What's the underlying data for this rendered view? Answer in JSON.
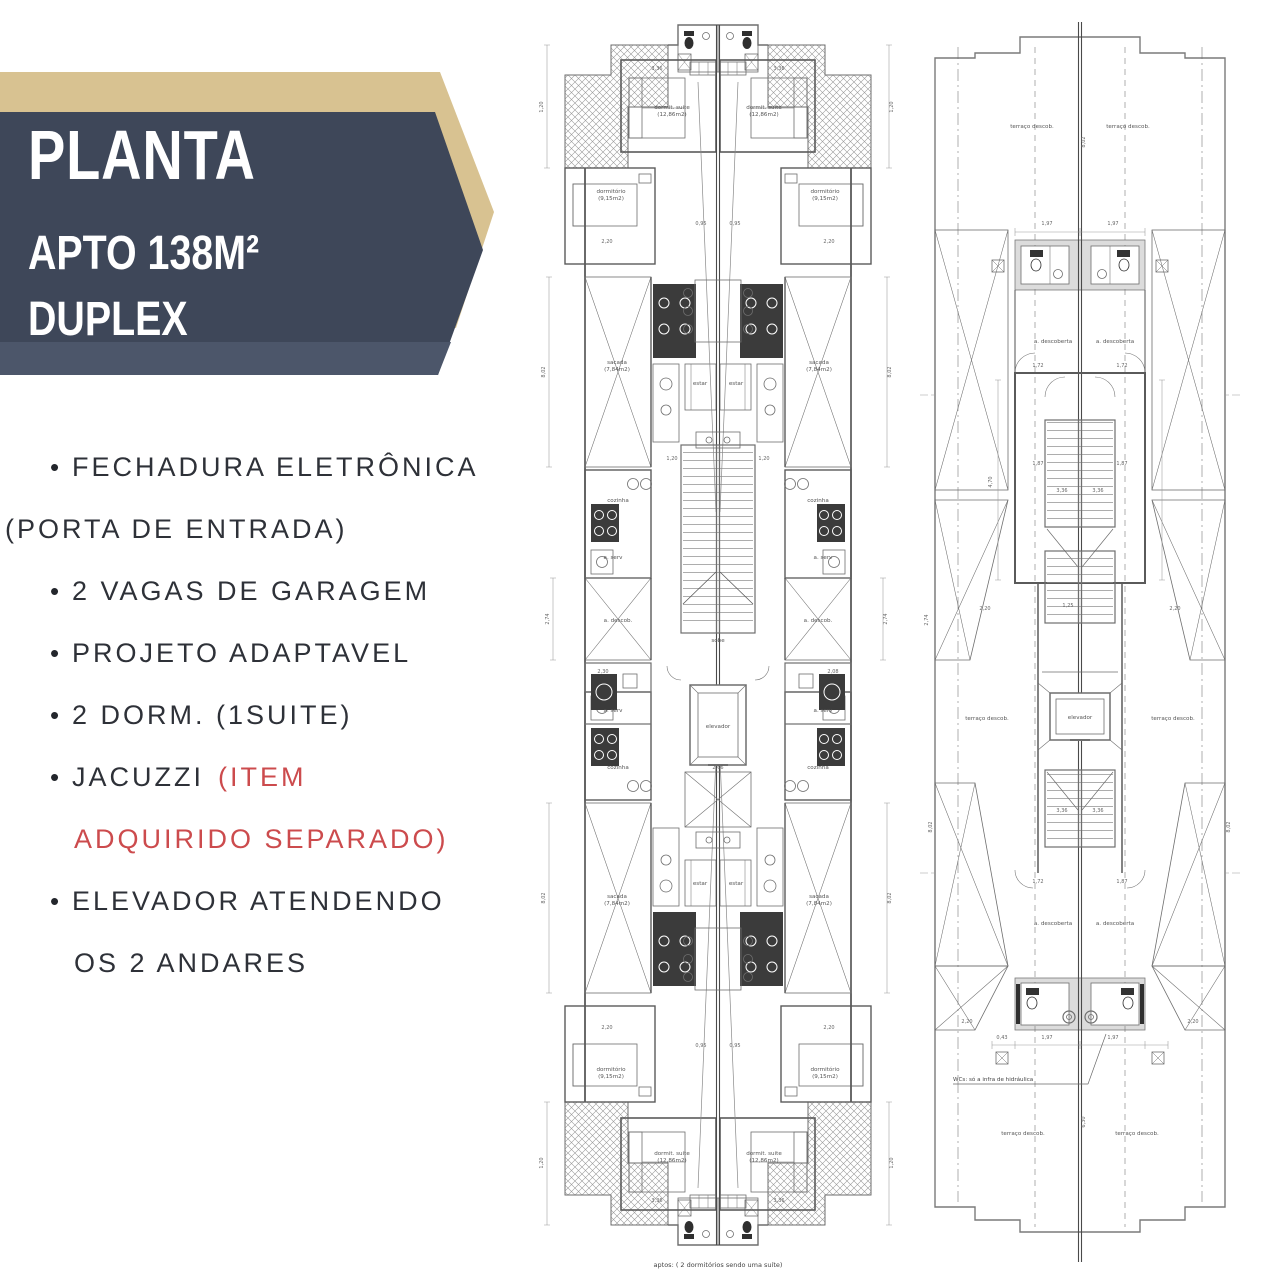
{
  "banner": {
    "title": "PLANTA",
    "subtitle": "APTO 138M²",
    "subtitle2": "DUPLEX",
    "accent_color": "#d8c291",
    "navy_color": "#3e4759"
  },
  "features": {
    "f1a": "FECHADURA ELETRÔNICA",
    "f1b": "(PORTA DE ENTRADA)",
    "f2": "2 VAGAS DE GARAGEM",
    "f3": "PROJETO ADAPTAVEL",
    "f4": "2 DORM. (1SUITE)",
    "f5a": "JACUZZI",
    "f5b": "(ITEM",
    "f5c": "ADQUIRIDO SEPARADO)",
    "f6a": "ELEVADOR ATENDENDO",
    "f6b": "OS 2 ANDARES",
    "highlight_color": "#cc4b4d"
  },
  "center_plan": {
    "caption": "aptos: ( 2 dormitórios sendo uma suíte)",
    "labels": [
      {
        "t": "dormit. suite",
        "x": 139,
        "y": 97
      },
      {
        "t": "(12,86m2)",
        "x": 139,
        "y": 104
      },
      {
        "t": "dormit. suite",
        "x": 231,
        "y": 97
      },
      {
        "t": "(12,86m2)",
        "x": 231,
        "y": 104
      },
      {
        "t": "dormitório",
        "x": 78,
        "y": 181
      },
      {
        "t": "(9,15m2)",
        "x": 78,
        "y": 188
      },
      {
        "t": "dormitório",
        "x": 292,
        "y": 181
      },
      {
        "t": "(9,15m2)",
        "x": 292,
        "y": 188
      },
      {
        "t": "sacada",
        "x": 84,
        "y": 352
      },
      {
        "t": "(7,84m2)",
        "x": 84,
        "y": 359
      },
      {
        "t": "sacada",
        "x": 286,
        "y": 352
      },
      {
        "t": "(7,84m2)",
        "x": 286,
        "y": 359
      },
      {
        "t": "estar",
        "x": 167,
        "y": 373
      },
      {
        "t": "estar",
        "x": 203,
        "y": 373
      },
      {
        "t": "cozinha",
        "x": 85,
        "y": 490
      },
      {
        "t": "cozinha",
        "x": 285,
        "y": 490
      },
      {
        "t": "a. serv",
        "x": 80,
        "y": 547
      },
      {
        "t": "a. serv",
        "x": 290,
        "y": 547
      },
      {
        "t": "a. descob.",
        "x": 85,
        "y": 610
      },
      {
        "t": "a. descob.",
        "x": 285,
        "y": 610
      },
      {
        "t": "sobe",
        "x": 185,
        "y": 630
      },
      {
        "t": "elevador",
        "x": 185,
        "y": 716
      },
      {
        "t": "a. serv",
        "x": 80,
        "y": 700
      },
      {
        "t": "a. serv",
        "x": 290,
        "y": 700
      },
      {
        "t": "cozinha",
        "x": 85,
        "y": 757
      },
      {
        "t": "cozinha",
        "x": 285,
        "y": 757
      },
      {
        "t": "estar",
        "x": 167,
        "y": 873
      },
      {
        "t": "estar",
        "x": 203,
        "y": 873
      },
      {
        "t": "sacada",
        "x": 84,
        "y": 886
      },
      {
        "t": "(7,84m2)",
        "x": 84,
        "y": 893
      },
      {
        "t": "sacada",
        "x": 286,
        "y": 886
      },
      {
        "t": "(7,84m2)",
        "x": 286,
        "y": 893
      },
      {
        "t": "dormitório",
        "x": 78,
        "y": 1059
      },
      {
        "t": "(9,15m2)",
        "x": 78,
        "y": 1066
      },
      {
        "t": "dormitório",
        "x": 292,
        "y": 1059
      },
      {
        "t": "(9,15m2)",
        "x": 292,
        "y": 1066
      },
      {
        "t": "dormit. suite",
        "x": 139,
        "y": 1143
      },
      {
        "t": "(12,86m2)",
        "x": 139,
        "y": 1150
      },
      {
        "t": "dormit. suite",
        "x": 231,
        "y": 1143
      },
      {
        "t": "(12,86m2)",
        "x": 231,
        "y": 1150
      }
    ],
    "dims": [
      {
        "t": "1,20",
        "x": 10,
        "y": 95,
        "r": 1
      },
      {
        "t": "8,02",
        "x": 12,
        "y": 360,
        "r": 1
      },
      {
        "t": "2,74",
        "x": 16,
        "y": 607,
        "r": 1
      },
      {
        "t": "8,02",
        "x": 12,
        "y": 886,
        "r": 1
      },
      {
        "t": "1,20",
        "x": 10,
        "y": 1151,
        "r": 1
      },
      {
        "t": "1,20",
        "x": 360,
        "y": 95,
        "r": 1
      },
      {
        "t": "8,02",
        "x": 358,
        "y": 360,
        "r": 1
      },
      {
        "t": "2,74",
        "x": 354,
        "y": 607,
        "r": 1
      },
      {
        "t": "8,02",
        "x": 358,
        "y": 886,
        "r": 1
      },
      {
        "t": "1,20",
        "x": 360,
        "y": 1151,
        "r": 1
      },
      {
        "t": "3,36",
        "x": 124,
        "y": 58
      },
      {
        "t": "3,36",
        "x": 246,
        "y": 58
      },
      {
        "t": "2,20",
        "x": 74,
        "y": 231
      },
      {
        "t": "2,20",
        "x": 296,
        "y": 231
      },
      {
        "t": "0,95",
        "x": 168,
        "y": 213
      },
      {
        "t": "0,95",
        "x": 202,
        "y": 213
      },
      {
        "t": "1,20",
        "x": 139,
        "y": 448
      },
      {
        "t": "1,20",
        "x": 231,
        "y": 448
      },
      {
        "t": "2,30",
        "x": 70,
        "y": 661
      },
      {
        "t": "2,08",
        "x": 300,
        "y": 661
      },
      {
        "t": "2,66",
        "x": 185,
        "y": 757
      },
      {
        "t": "2,20",
        "x": 74,
        "y": 1017
      },
      {
        "t": "2,20",
        "x": 296,
        "y": 1017
      },
      {
        "t": "0,95",
        "x": 168,
        "y": 1035
      },
      {
        "t": "0,95",
        "x": 202,
        "y": 1035
      },
      {
        "t": "3,36",
        "x": 124,
        "y": 1190
      },
      {
        "t": "3,36",
        "x": 246,
        "y": 1190
      }
    ]
  },
  "right_plan": {
    "note": "WCs: só a infra de hidráulica",
    "labels": [
      {
        "t": "terraço descob.",
        "x": 112,
        "y": 106
      },
      {
        "t": "terraço descob.",
        "x": 208,
        "y": 106
      },
      {
        "t": "a. descoberta",
        "x": 133,
        "y": 321
      },
      {
        "t": "a. descoberta",
        "x": 195,
        "y": 321
      },
      {
        "t": "terraço descob.",
        "x": 67,
        "y": 698
      },
      {
        "t": "terraço descob.",
        "x": 253,
        "y": 698
      },
      {
        "t": "elevador",
        "x": 160,
        "y": 697
      },
      {
        "t": "a. descoberta",
        "x": 133,
        "y": 903
      },
      {
        "t": "a. descoberta",
        "x": 195,
        "y": 903
      },
      {
        "t": "terraço descob.",
        "x": 103,
        "y": 1113
      },
      {
        "t": "terraço descob.",
        "x": 217,
        "y": 1113
      }
    ],
    "dims": [
      {
        "t": "8,02",
        "x": 165,
        "y": 120,
        "r": 1
      },
      {
        "t": "1,97",
        "x": 127,
        "y": 203
      },
      {
        "t": "1,97",
        "x": 193,
        "y": 203
      },
      {
        "t": "1,72",
        "x": 118,
        "y": 345
      },
      {
        "t": "1,72",
        "x": 202,
        "y": 345
      },
      {
        "t": "1,87",
        "x": 118,
        "y": 443
      },
      {
        "t": "1,87",
        "x": 202,
        "y": 443
      },
      {
        "t": "4,70",
        "x": 72,
        "y": 460,
        "r": 1
      },
      {
        "t": "2,74",
        "x": 8,
        "y": 598,
        "r": 1
      },
      {
        "t": "2,20",
        "x": 65,
        "y": 588
      },
      {
        "t": "2,20",
        "x": 255,
        "y": 588
      },
      {
        "t": "3,36",
        "x": 142,
        "y": 470
      },
      {
        "t": "3,36",
        "x": 178,
        "y": 470
      },
      {
        "t": "1,25",
        "x": 148,
        "y": 585
      },
      {
        "t": "3,36",
        "x": 142,
        "y": 790
      },
      {
        "t": "3,36",
        "x": 178,
        "y": 790
      },
      {
        "t": "1,72",
        "x": 118,
        "y": 861
      },
      {
        "t": "1,87",
        "x": 202,
        "y": 861
      },
      {
        "t": "8,02",
        "x": 12,
        "y": 805,
        "r": 1
      },
      {
        "t": "8,02",
        "x": 310,
        "y": 805,
        "r": 1
      },
      {
        "t": "2,20",
        "x": 47,
        "y": 1001
      },
      {
        "t": "2,20",
        "x": 273,
        "y": 1001
      },
      {
        "t": "0,43",
        "x": 82,
        "y": 1017
      },
      {
        "t": "1,97",
        "x": 127,
        "y": 1017
      },
      {
        "t": "1,97",
        "x": 193,
        "y": 1017
      },
      {
        "t": "6,30",
        "x": 165,
        "y": 1100,
        "r": 1
      }
    ]
  }
}
